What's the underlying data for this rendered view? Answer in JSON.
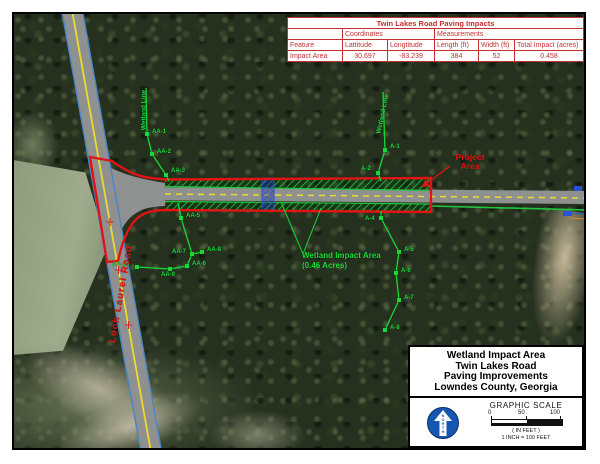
{
  "impact_table": {
    "title": "Twin Lakes Road Paving Impacts",
    "group_coordinates": "Coordinates",
    "group_measurements": "Measurements",
    "columns": [
      "Feature",
      "Lattitude",
      "Longtitude",
      "Length (ft)",
      "Width (ft)",
      "Total Impact (acres)"
    ],
    "rows": [
      [
        "Impact Area",
        "30.697",
        "-83.239",
        "384",
        "52",
        "0.458"
      ]
    ]
  },
  "map": {
    "labels": {
      "wetland_line_left": "Wetland Line",
      "wetland_line_right": "Wetland Line",
      "loch_laurel_road": "Loch Laurel Road",
      "project_area": "Project Area",
      "wetland_impact_line1": "Wetland Impact Area",
      "wetland_impact_line2": "(0.46 Acres)"
    },
    "flags": [
      {
        "label": "AA-1",
        "cx": 133,
        "cy": 120,
        "tx": 138,
        "ty": 115
      },
      {
        "label": "AA-2",
        "cx": 138,
        "cy": 140,
        "tx": 143,
        "ty": 135
      },
      {
        "label": "AA-3",
        "cx": 152,
        "cy": 161,
        "tx": 157,
        "ty": 154
      },
      {
        "label": "AA-5",
        "cx": 167,
        "cy": 204,
        "tx": 172,
        "ty": 199
      },
      {
        "label": "AA-7",
        "cx": 178,
        "cy": 240,
        "tx": 158,
        "ty": 235
      },
      {
        "label": "AA-8",
        "cx": 188,
        "cy": 238,
        "tx": 193,
        "ty": 233
      },
      {
        "label": "AA-6",
        "cx": 173,
        "cy": 252,
        "tx": 178,
        "ty": 247
      },
      {
        "label": "AA-9",
        "cx": 156,
        "cy": 255,
        "tx": 147,
        "ty": 258
      },
      {
        "label": "AA-10",
        "cx": 123,
        "cy": 253,
        "tx": 98,
        "ty": 248
      },
      {
        "label": "A-1",
        "cx": 371,
        "cy": 136,
        "tx": 376,
        "ty": 130
      },
      {
        "label": "A-2",
        "cx": 364,
        "cy": 159,
        "tx": 347,
        "ty": 152
      },
      {
        "label": "A-4",
        "cx": 367,
        "cy": 204,
        "tx": 351,
        "ty": 202
      },
      {
        "label": "A-5",
        "cx": 385,
        "cy": 238,
        "tx": 390,
        "ty": 233
      },
      {
        "label": "A-6",
        "cx": 382,
        "cy": 259,
        "tx": 387,
        "ty": 254
      },
      {
        "label": "A-7",
        "cx": 385,
        "cy": 286,
        "tx": 390,
        "ty": 281
      },
      {
        "label": "A-8",
        "cx": 371,
        "cy": 316,
        "tx": 376,
        "ty": 311
      }
    ]
  },
  "title_block": {
    "lines": [
      "Wetland Impact Area",
      "Twin Lakes Road",
      "Paving Improvements",
      "Lowndes County, Georgia"
    ]
  },
  "north_arrow": {
    "label": "NORTH"
  },
  "scale": {
    "heading": "GRAPHIC SCALE",
    "ticks": [
      "0",
      "50",
      "100"
    ],
    "units": "( IN FEET )",
    "ratio": "1 INCH = 100 FEET"
  },
  "colors": {
    "project_red": "#e01414",
    "wetland_green": "#1ade3c",
    "road_yellow": "#ecd92b",
    "water_blue": "#2a52d8",
    "table_red": "#c43030",
    "north_blue": "#1557b0"
  }
}
